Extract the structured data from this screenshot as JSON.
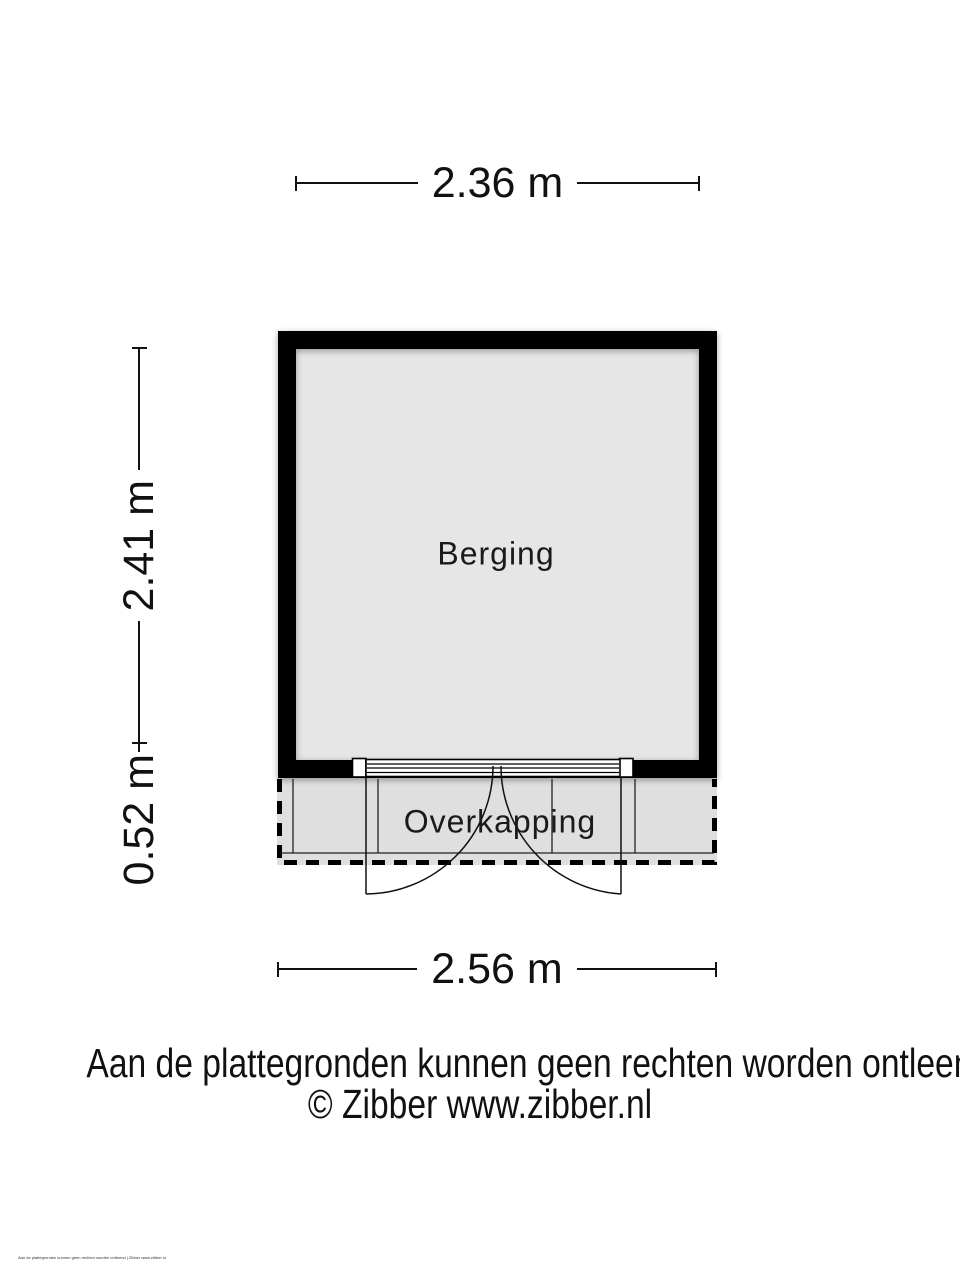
{
  "floorplan": {
    "room_label": "Berging",
    "canopy_label": "Overkapping",
    "dimensions": {
      "top_width": "2.36 m",
      "left_height": "2.41 m",
      "canopy_height": "0.52 m",
      "bottom_width": "2.56 m"
    },
    "colors": {
      "wall": "#000000",
      "room_fill": "#e6e6e6",
      "canopy_fill": "#dfdfdf",
      "line": "#111111"
    }
  },
  "footer": {
    "disclaimer": "Aan de plattegronden kunnen geen rechten worden ontleend",
    "credit": "© Zibber www.zibber.nl",
    "fineprint": "Aan de plattegronden kunnen geen rechten worden ontleend | Zibber www.zibber.nl"
  }
}
